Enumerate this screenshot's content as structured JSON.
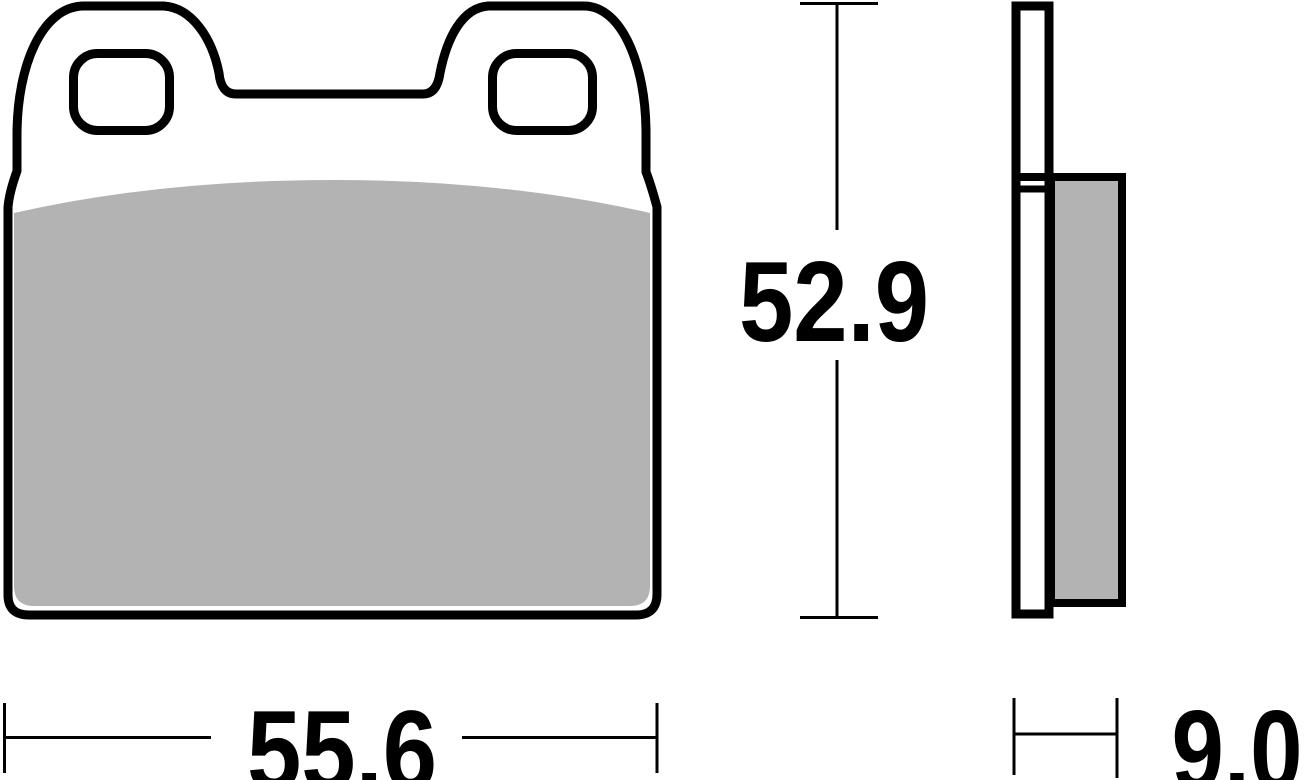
{
  "drawing": {
    "subject": "brake-pad-technical-drawing",
    "views": {
      "front": "front profile with two mounting-tab ears, two mounting holes and friction material",
      "side": "edge profile showing backing plate and friction material thickness"
    },
    "dimensions": {
      "width_mm": "55.6",
      "height_mm": "52.9",
      "thickness_mm": "9.0"
    },
    "colors": {
      "outline": "#000000",
      "friction_material": "#b3b3b3",
      "background": "#ffffff"
    }
  }
}
